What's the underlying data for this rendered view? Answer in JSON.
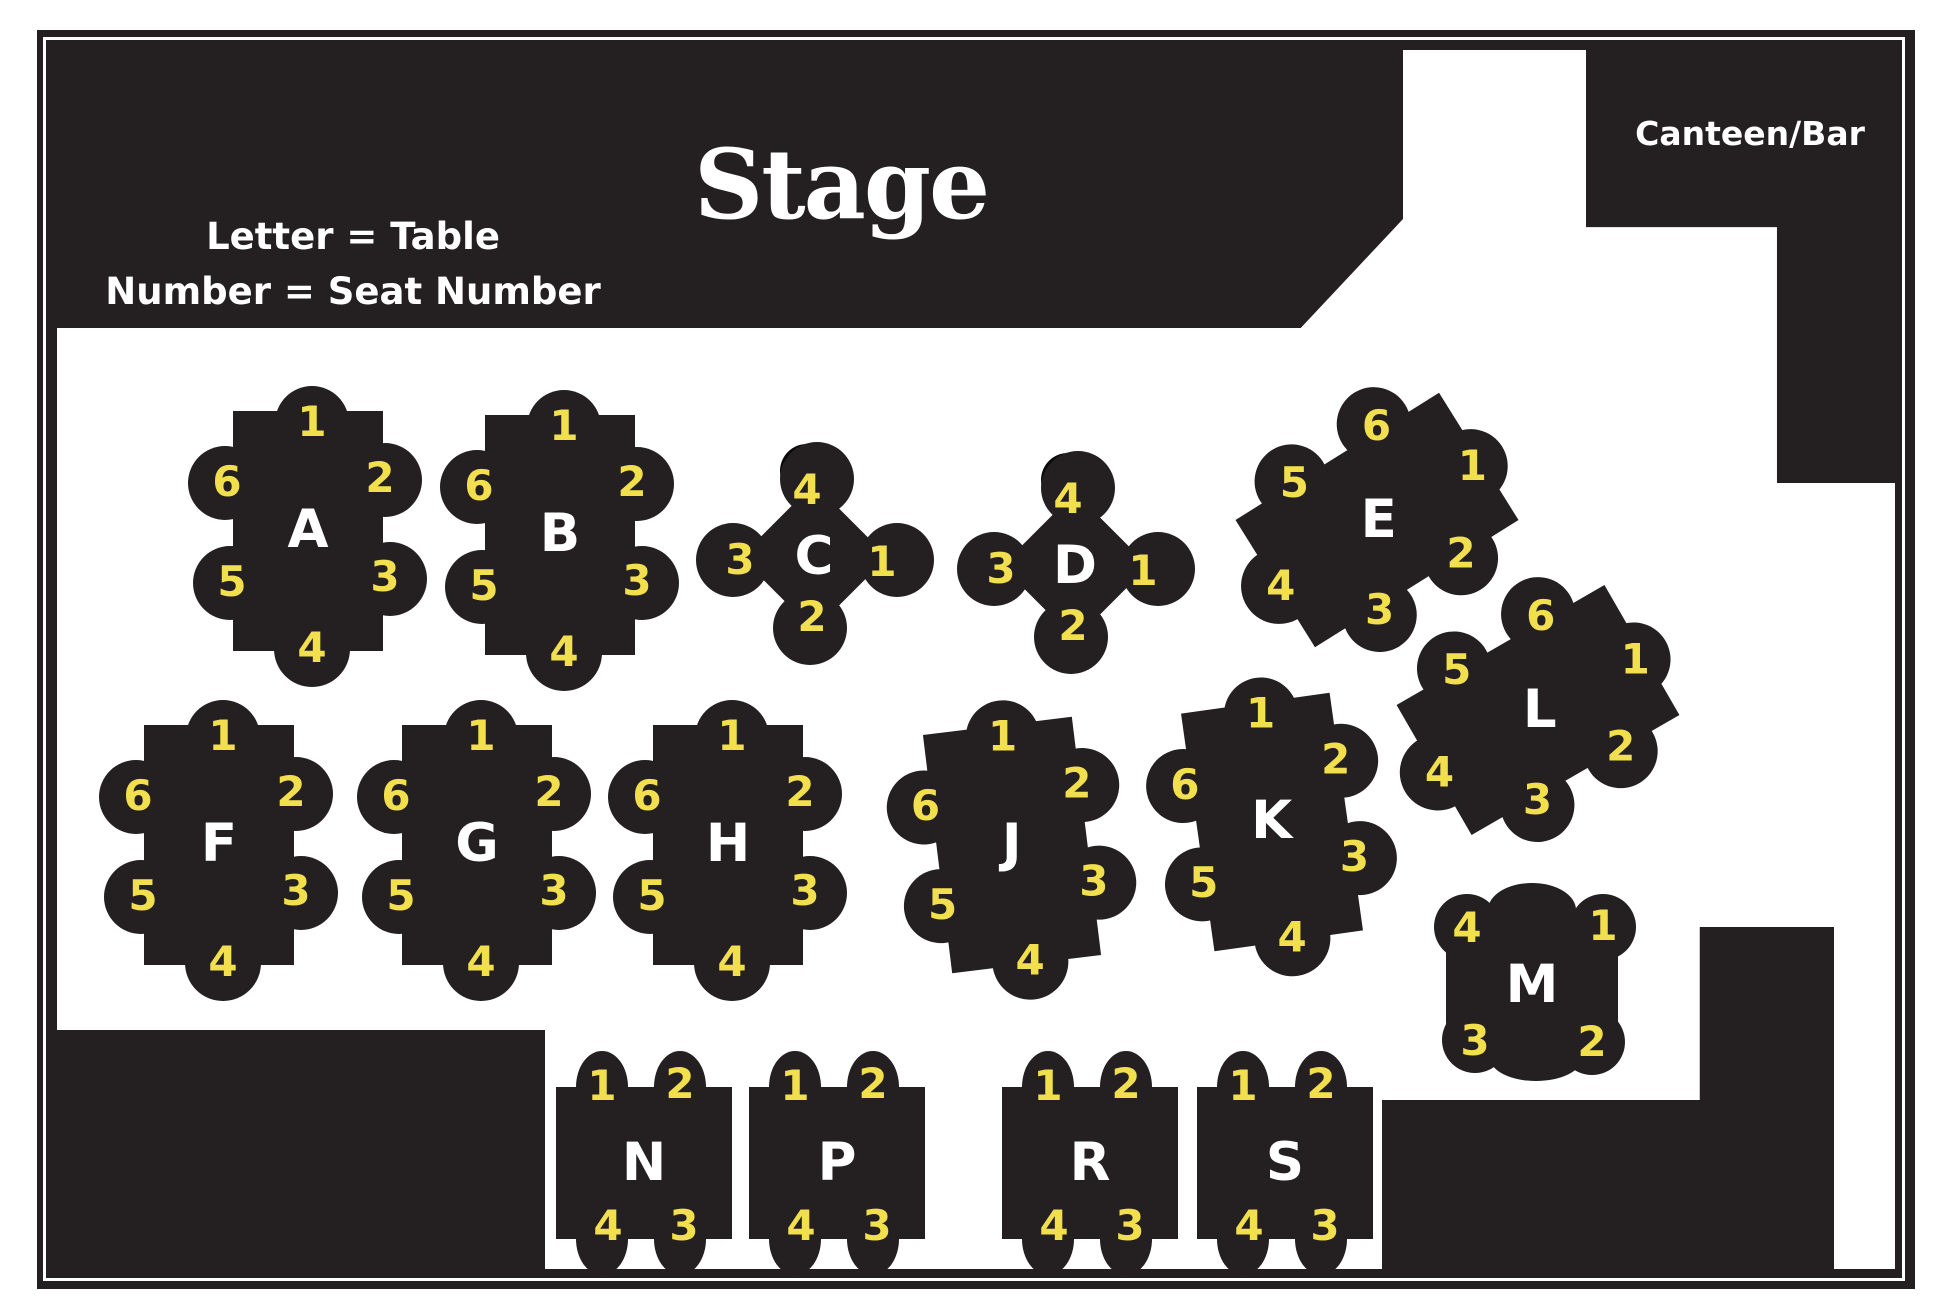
{
  "title": "Venue seating plan",
  "areas": {
    "stage_label": "Stage",
    "canteen_label": "Canteen/Bar",
    "legend_line1": "Letter = Table",
    "legend_line2": "Number = Seat Number"
  },
  "colors": {
    "ink": "#241F20",
    "seat_number_yellow": "#F2DF4E",
    "letter_white": "#FFFFFF",
    "floor_white": "#FFFFFF",
    "spare_chair_black": "#0B0A0A"
  },
  "tables": [
    {
      "letter": "A",
      "kind": "six",
      "x": 308,
      "y": 531,
      "rot": 0,
      "seats": [
        "1",
        "2",
        "3",
        "4",
        "5",
        "6"
      ]
    },
    {
      "letter": "B",
      "kind": "six",
      "x": 560,
      "y": 535,
      "rot": 0,
      "seats": [
        "1",
        "2",
        "3",
        "4",
        "5",
        "6"
      ]
    },
    {
      "letter": "C",
      "kind": "diamond",
      "x": 814,
      "y": 557,
      "rot": 0,
      "seats": [
        "4",
        "1",
        "2",
        "3"
      ]
    },
    {
      "letter": "D",
      "kind": "diamond",
      "x": 1075,
      "y": 566,
      "rot": 0,
      "seats": [
        "4",
        "1",
        "2",
        "3"
      ]
    },
    {
      "letter": "E",
      "kind": "six",
      "x": 1377,
      "y": 520,
      "rot": 58,
      "seats": [
        "1",
        "2",
        "3",
        "4",
        "5",
        "6"
      ]
    },
    {
      "letter": "L",
      "kind": "six",
      "x": 1538,
      "y": 710,
      "rot": 60,
      "seats": [
        "1",
        "2",
        "3",
        "4",
        "5",
        "6"
      ]
    },
    {
      "letter": "F",
      "kind": "six",
      "x": 219,
      "y": 845,
      "rot": 0,
      "seats": [
        "1",
        "2",
        "3",
        "4",
        "5",
        "6"
      ]
    },
    {
      "letter": "G",
      "kind": "six",
      "x": 477,
      "y": 845,
      "rot": 0,
      "seats": [
        "1",
        "2",
        "3",
        "4",
        "5",
        "6"
      ]
    },
    {
      "letter": "H",
      "kind": "six",
      "x": 728,
      "y": 845,
      "rot": 0,
      "seats": [
        "1",
        "2",
        "3",
        "4",
        "5",
        "6"
      ]
    },
    {
      "letter": "J",
      "kind": "six",
      "x": 1012,
      "y": 845,
      "rot": -7,
      "seats": [
        "1",
        "2",
        "3",
        "4",
        "5",
        "6"
      ]
    },
    {
      "letter": "K",
      "kind": "six",
      "x": 1272,
      "y": 822,
      "rot": -8,
      "seats": [
        "1",
        "2",
        "3",
        "4",
        "5",
        "6"
      ]
    },
    {
      "letter": "M",
      "kind": "corner",
      "x": 1532,
      "y": 984,
      "rot": 0,
      "seats": [
        "4",
        "1",
        "3",
        "2"
      ]
    },
    {
      "letter": "N",
      "kind": "four",
      "x": 644,
      "y": 1163,
      "rot": 0,
      "seats": [
        "1",
        "2",
        "3",
        "4"
      ]
    },
    {
      "letter": "P",
      "kind": "four",
      "x": 837,
      "y": 1163,
      "rot": 0,
      "seats": [
        "1",
        "2",
        "3",
        "4"
      ]
    },
    {
      "letter": "R",
      "kind": "four",
      "x": 1090,
      "y": 1163,
      "rot": 0,
      "seats": [
        "1",
        "2",
        "3",
        "4"
      ]
    },
    {
      "letter": "S",
      "kind": "four",
      "x": 1285,
      "y": 1163,
      "rot": 0,
      "seats": [
        "1",
        "2",
        "3",
        "4"
      ]
    }
  ]
}
